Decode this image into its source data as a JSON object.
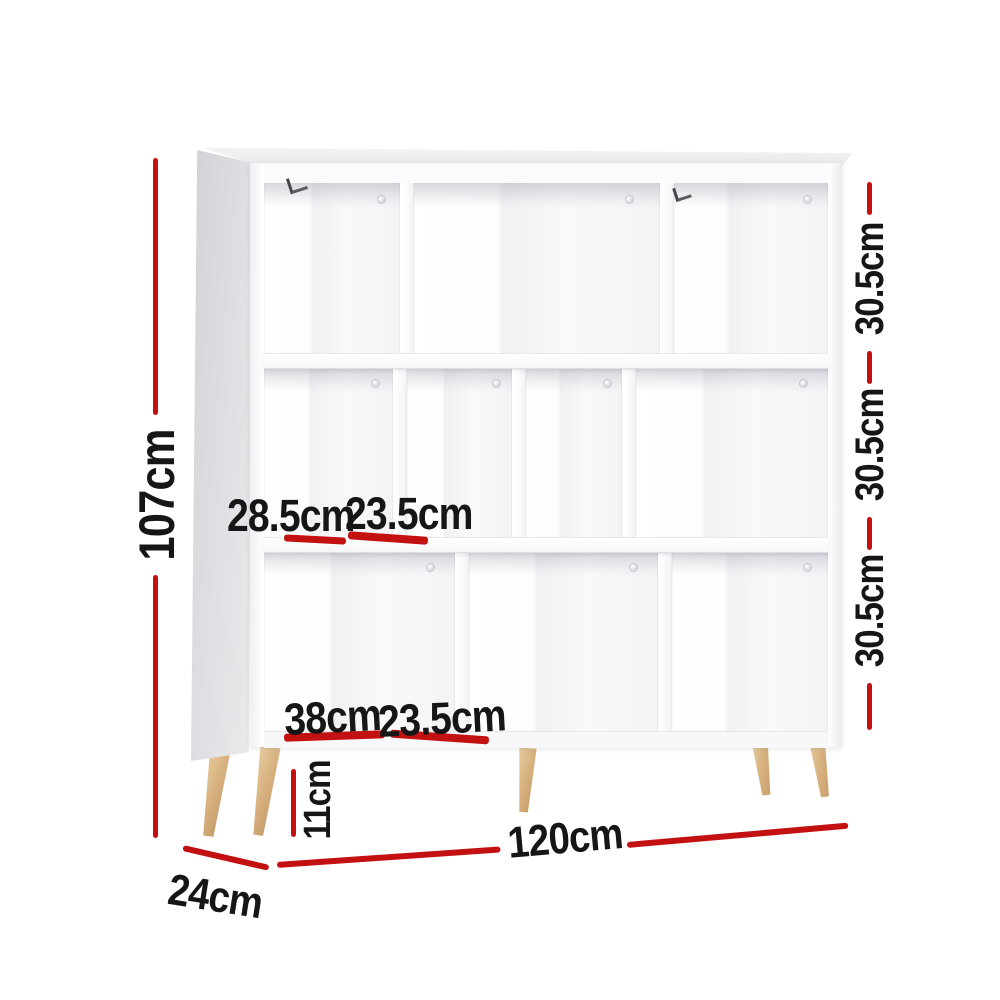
{
  "figure": {
    "type": "product-dimension-diagram",
    "subject": "3-tier staggered cube display shelf with wooden legs",
    "colors": {
      "dimension_line": "#c31111",
      "dimension_text": "#161616",
      "cabinet_white": "#fcfcfd",
      "leg_wood": "#d6b07e"
    }
  },
  "dimensions": {
    "overall_height": "107cm",
    "overall_width": "120cm",
    "overall_depth": "24cm",
    "leg_height": "11cm",
    "row_heights": [
      "30.5cm",
      "30.5cm",
      "30.5cm"
    ],
    "middle_row_compartment_widths": [
      "28.5cm",
      "23.5cm"
    ],
    "bottom_row_compartment_widths": [
      "38cm",
      "23.5cm"
    ]
  }
}
